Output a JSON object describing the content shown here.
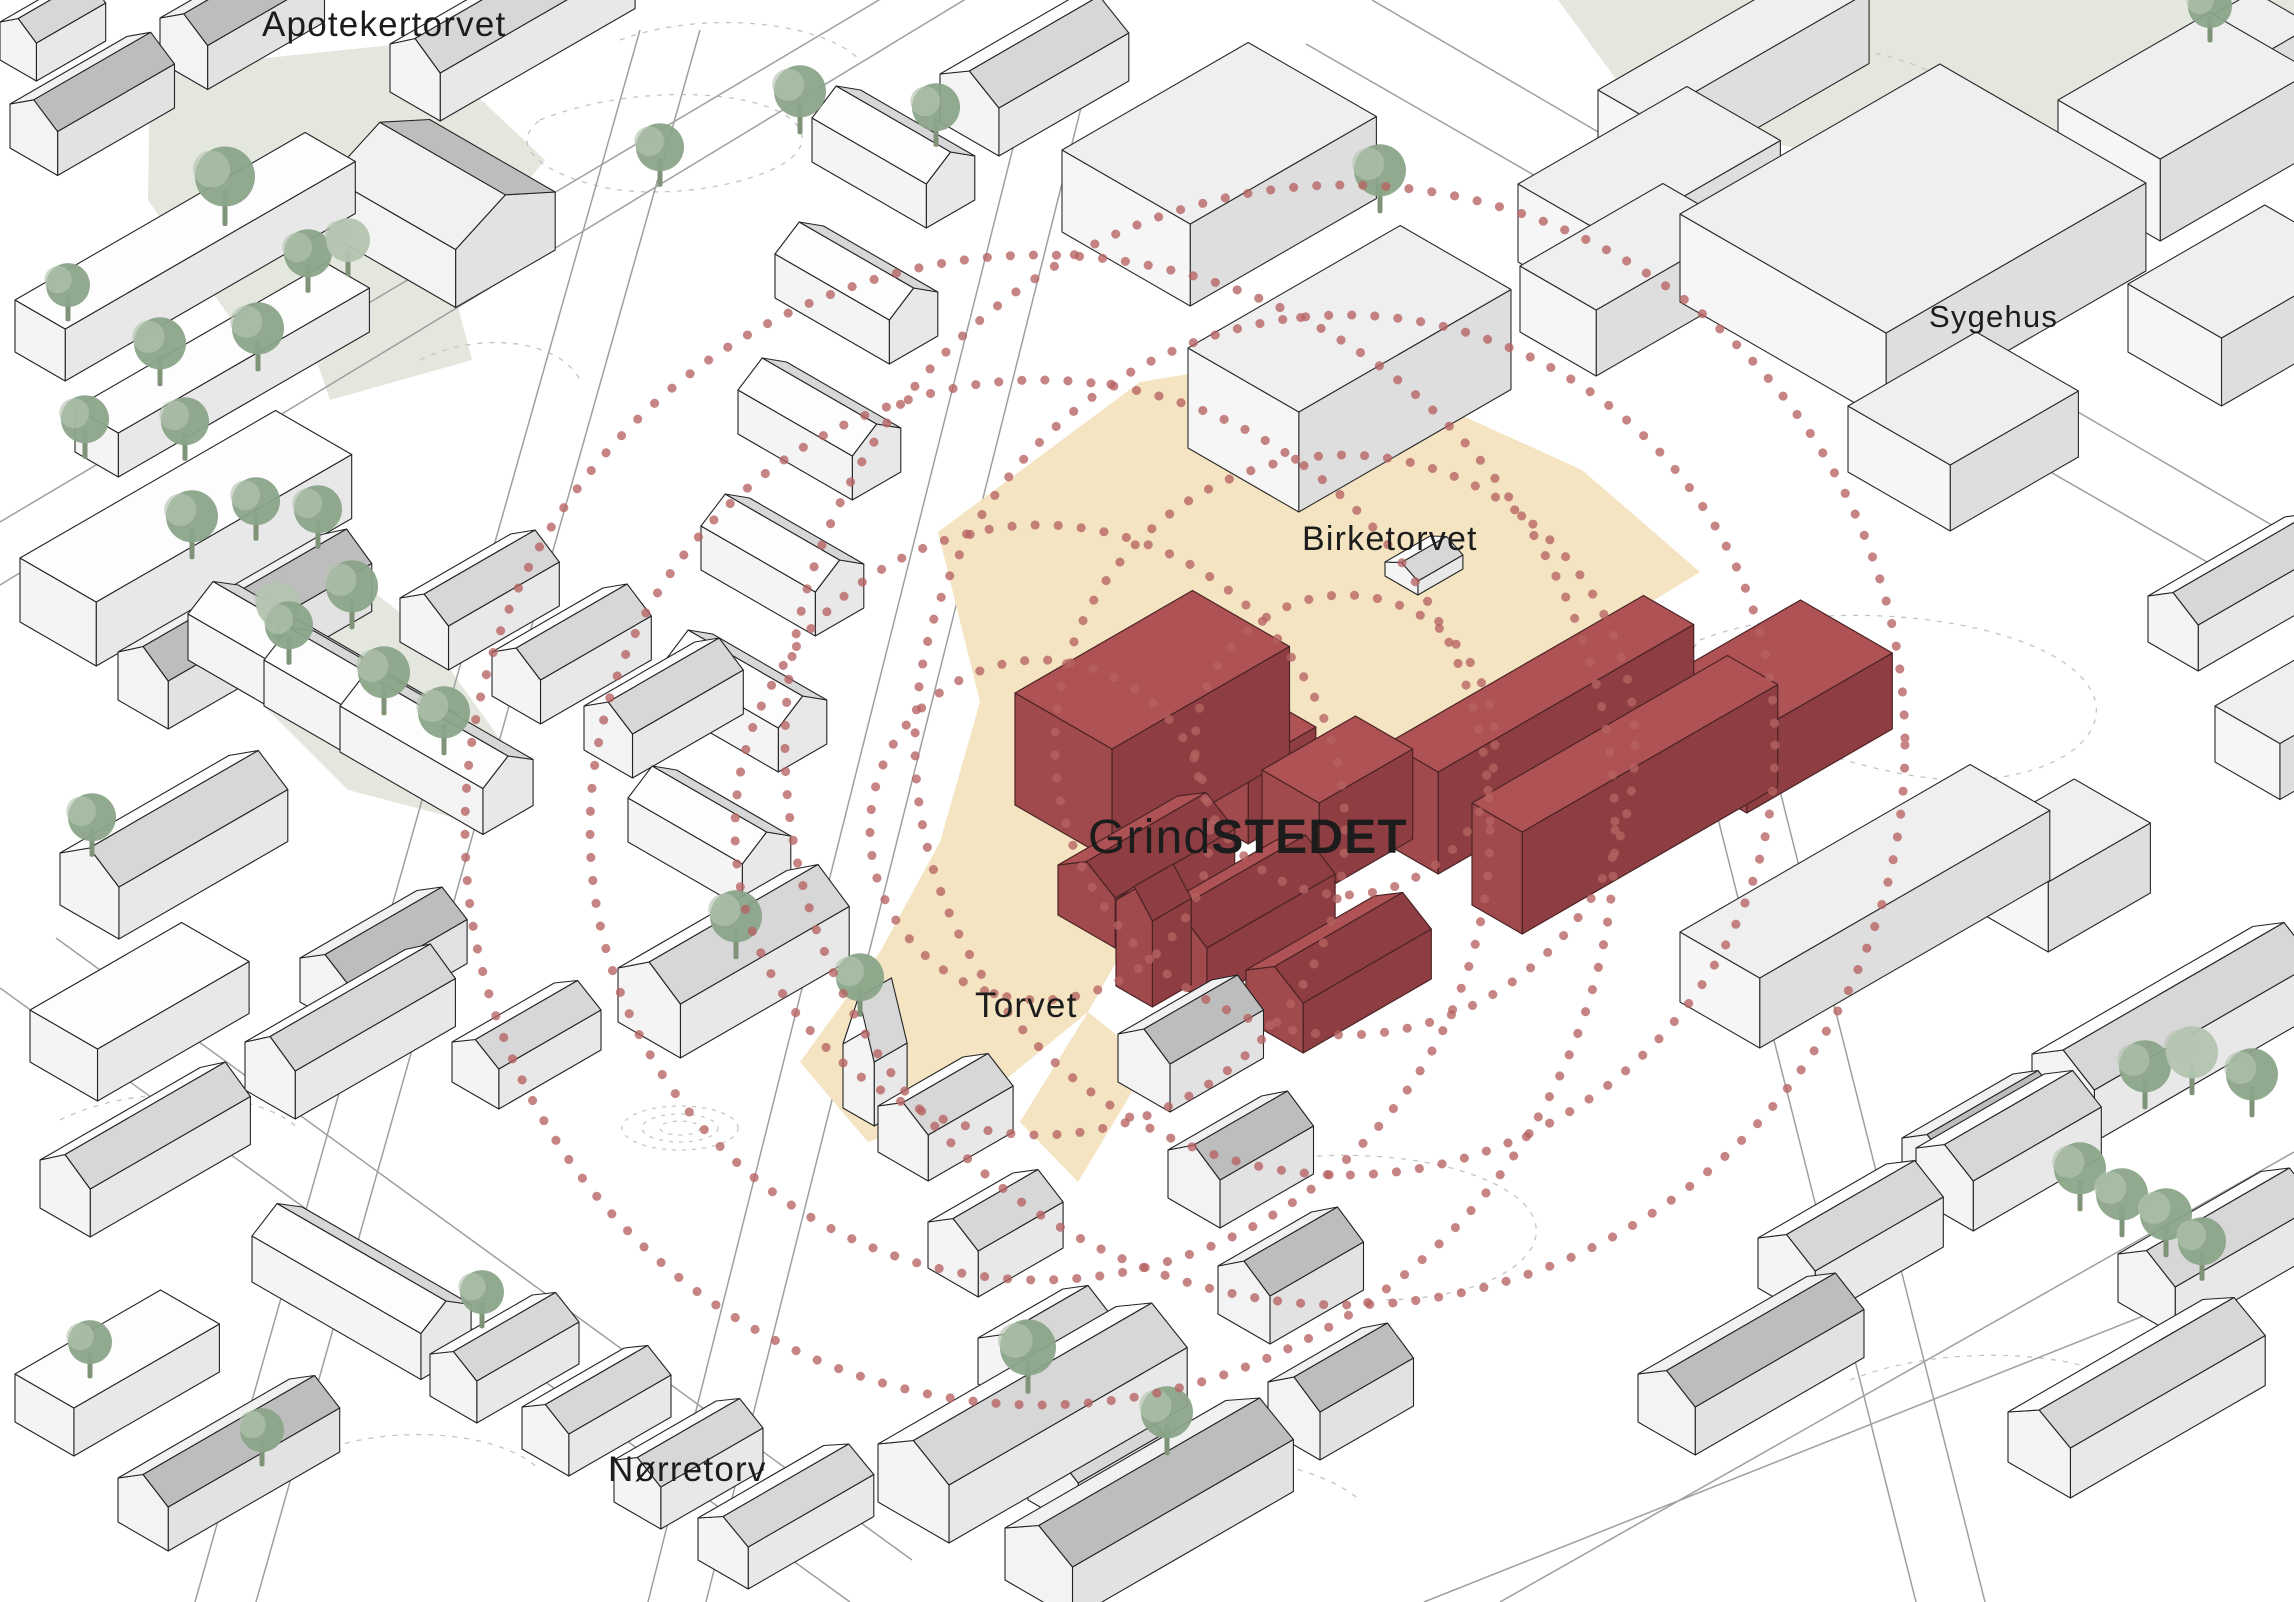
{
  "labels": {
    "apotekertorvet": {
      "text": "Apotekertorvet",
      "x": 262,
      "y": 36,
      "size": 35
    },
    "sygehus": {
      "text": "Sygehus",
      "x": 1929,
      "y": 327,
      "size": 31
    },
    "birketorvet": {
      "text": "Birketorvet",
      "x": 1302,
      "y": 550,
      "size": 34
    },
    "grindstedet": {
      "regular": "Grind",
      "bold": "STEDET",
      "x": 1088,
      "y": 853,
      "size": 48
    },
    "torvet": {
      "text": "Torvet",
      "x": 975,
      "y": 1017,
      "size": 35
    },
    "norretorv": {
      "text": "Nørretorv",
      "x": 608,
      "y": 1481,
      "size": 35
    }
  },
  "palette": {
    "background": "#ffffff",
    "beige": "#f4e4c2",
    "park": "#e4e7de",
    "red_top": "#ae5255",
    "red_side_dark": "#8e3e42",
    "red_side_light": "#a04a4e",
    "red_line": "#4b2324",
    "dots": "#b66361",
    "tree": "#8aa489",
    "tree_light": "#b3c4b0",
    "trunk": "#7f9379",
    "ink": "#1c1c1c",
    "road": "#9f9f9f",
    "contour": "#c4c4c4"
  },
  "scene": {
    "width": 2294,
    "height": 1602,
    "ground": [
      {
        "points": "150,70 420,42 545,160 430,300 240,332 148,200",
        "fill": "park"
      },
      {
        "points": "285,268 445,258 472,360 330,400",
        "fill": "park"
      },
      {
        "points": "168,560 280,518 422,630 502,742 470,822 348,790 218,660",
        "fill": "park"
      },
      {
        "points": "1558,0 2294,0 2294,112 1898,172 1640,112",
        "fill": "park"
      }
    ],
    "plazas": [
      {
        "points": "938,532 1140,382 1322,352 1582,470 1700,572 1520,682 1338,772 1202,802 1150,902 1088,1012 978,1102 868,1142 800,1062 880,952 940,842 980,702",
        "fill": "beige"
      },
      {
        "points": "1088,1012 1150,1062 1078,1182 1020,1122",
        "fill": "beige"
      }
    ],
    "roads": [
      [
        648,
        1602,
        1040,
        40
      ],
      [
        706,
        1602,
        1098,
        40
      ],
      [
        195,
        1602,
        640,
        30
      ],
      [
        256,
        1602,
        700,
        30
      ],
      [
        0,
        522,
        980,
        -60
      ],
      [
        0,
        585,
        1030,
        -40
      ],
      [
        0,
        988,
        850,
        1602
      ],
      [
        56,
        938,
        912,
        1560
      ],
      [
        1372,
        0,
        2294,
        538
      ],
      [
        1306,
        44,
        2294,
        612
      ],
      [
        1500,
        1602,
        2294,
        1152
      ],
      [
        1424,
        1602,
        2294,
        1256
      ],
      [
        1688,
        700,
        1916,
        1602
      ],
      [
        1757,
        700,
        1985,
        1602
      ]
    ],
    "contours": [
      "M540,120 C640,80 780,90 800,130 C820,170 700,200 620,190 C560,182 500,150 540,120",
      "M620,40 C700,10 820,20 860,60",
      "M1650,60 C1750,30 1900,40 1960,90 C2000,130 1930,170 1840,160",
      "M1700,640 C1800,600 1980,610 2060,660 C2140,710 2080,780 1960,780 C1860,780 1640,700 1700,640",
      "M1200,1180 C1300,1140 1460,1150 1520,1200 C1570,1245 1500,1300 1380,1300",
      "M300,1460 C380,1420 500,1430 540,1470",
      "M1050,1480 C1150,1440 1300,1450 1360,1500",
      "M420,360 C480,330 560,340 580,380",
      "M1850,1380 C1950,1340 2100,1350 2160,1400",
      "M60,1120 C140,1080 260,1090 300,1130"
    ],
    "spirals": [
      [
        680,
        1128,
        58,
        22
      ],
      [
        680,
        1128,
        38,
        14
      ],
      [
        680,
        1128,
        20,
        7
      ],
      [
        1100,
        1547,
        60,
        22
      ],
      [
        1100,
        1547,
        35,
        12
      ]
    ],
    "circle_families": [
      {
        "cx": 1040,
        "cy": 830,
        "r": [
          170,
          305,
          450,
          575
        ]
      },
      {
        "cx": 1345,
        "cy": 745,
        "r": [
          150,
          290,
          430,
          560
        ]
      }
    ],
    "buildings": [
      [
        10,
        148,
        135,
        55,
        44,
        "d",
        1,
        18
      ],
      [
        160,
        62,
        135,
        55,
        44,
        "d",
        1,
        18
      ],
      [
        390,
        92,
        225,
        58,
        48,
        "w",
        1,
        20
      ],
      [
        330,
        235,
        115,
        145,
        58,
        "d",
        2,
        26
      ],
      [
        15,
        352,
        335,
        58,
        52,
        "w",
        0,
        0
      ],
      [
        75,
        452,
        290,
        50,
        44,
        "w",
        0,
        0
      ],
      [
        0,
        60,
        80,
        42,
        38,
        "w",
        1,
        14
      ],
      [
        20,
        622,
        295,
        88,
        64,
        "w",
        0,
        0
      ],
      [
        118,
        700,
        235,
        58,
        48,
        "d",
        1,
        20
      ],
      [
        60,
        905,
        195,
        68,
        52,
        "w",
        1,
        22
      ],
      [
        30,
        1062,
        175,
        78,
        52,
        "w",
        0,
        0
      ],
      [
        300,
        1002,
        135,
        58,
        44,
        "d",
        1,
        18
      ],
      [
        452,
        1082,
        118,
        54,
        40,
        "w",
        1,
        16
      ],
      [
        252,
        1282,
        58,
        195,
        46,
        "w",
        2,
        18
      ],
      [
        15,
        1422,
        168,
        68,
        48,
        "w",
        0,
        0
      ],
      [
        118,
        1522,
        198,
        58,
        44,
        "d",
        1,
        18
      ],
      [
        878,
        1502,
        275,
        82,
        58,
        "w",
        1,
        24
      ],
      [
        1005,
        1580,
        255,
        78,
        52,
        "d",
        1,
        22
      ],
      [
        698,
        1560,
        145,
        58,
        42,
        "w",
        1,
        16
      ],
      [
        940,
        122,
        150,
        68,
        48,
        "w",
        1,
        20
      ],
      [
        1062,
        232,
        215,
        148,
        82,
        "g",
        0,
        0
      ],
      [
        1188,
        448,
        245,
        128,
        100,
        "g",
        0,
        0
      ],
      [
        1385,
        576,
        52,
        38,
        14,
        "w",
        1,
        9
      ],
      [
        1520,
        332,
        165,
        88,
        66,
        "g",
        0,
        0
      ],
      [
        1680,
        302,
        300,
        238,
        88,
        "g",
        0,
        0
      ],
      [
        1518,
        262,
        195,
        108,
        78,
        "g",
        0,
        0
      ],
      [
        1598,
        162,
        255,
        58,
        72,
        "g",
        0,
        0
      ],
      [
        2058,
        182,
        175,
        118,
        82,
        "g",
        0,
        0
      ],
      [
        2128,
        352,
        158,
        108,
        68,
        "g",
        0,
        0
      ],
      [
        1848,
        472,
        148,
        118,
        66,
        "g",
        0,
        0
      ],
      [
        2180,
        122,
        85,
        68,
        88,
        "g",
        0,
        0
      ],
      [
        1015,
        805,
        205,
        112,
        112,
        "r",
        0,
        0
      ],
      [
        1198,
        815,
        78,
        58,
        78,
        "r",
        0,
        0
      ],
      [
        1262,
        860,
        108,
        66,
        90,
        "r",
        0,
        0
      ],
      [
        1388,
        845,
        295,
        58,
        102,
        "r",
        0,
        0
      ],
      [
        1472,
        905,
        295,
        58,
        102,
        "r",
        0,
        0
      ],
      [
        1655,
        760,
        168,
        106,
        76,
        "r",
        0,
        0
      ],
      [
        1058,
        915,
        138,
        66,
        50,
        "r",
        1,
        20
      ],
      [
        1148,
        968,
        148,
        68,
        54,
        "r",
        1,
        22
      ],
      [
        1246,
        1020,
        148,
        66,
        50,
        "r",
        1,
        20
      ],
      [
        1116,
        986,
        45,
        42,
        86,
        "r",
        1,
        24
      ],
      [
        1680,
        1002,
        335,
        92,
        70,
        "g",
        0,
        0
      ],
      [
        1972,
        908,
        118,
        88,
        70,
        "g",
        0,
        0
      ],
      [
        2032,
        1106,
        255,
        72,
        52,
        "w",
        1,
        22
      ],
      [
        1902,
        1182,
        128,
        58,
        44,
        "d",
        1,
        18
      ],
      [
        2118,
        1302,
        165,
        66,
        48,
        "w",
        1,
        20
      ],
      [
        1638,
        1422,
        195,
        66,
        48,
        "d",
        1,
        20
      ],
      [
        2008,
        1462,
        225,
        72,
        50,
        "w",
        1,
        20
      ],
      [
        2148,
        642,
        158,
        58,
        46,
        "w",
        1,
        18
      ],
      [
        2215,
        762,
        135,
        75,
        56,
        "g",
        0,
        0
      ],
      [
        618,
        1022,
        195,
        72,
        54,
        "w",
        1,
        24
      ],
      [
        843,
        1108,
        38,
        36,
        64,
        "w",
        1,
        56
      ],
      [
        628,
        842,
        56,
        132,
        44,
        "w",
        2,
        18
      ]
    ],
    "building_rows": [
      [
        400,
        642,
        3,
        92,
        54,
        128,
        56,
        44,
        "w",
        1,
        18
      ],
      [
        188,
        660,
        3,
        76,
        46,
        58,
        165,
        46,
        "w",
        2,
        18
      ],
      [
        40,
        1208,
        2,
        205,
        -118,
        185,
        58,
        48,
        "w",
        1,
        20
      ],
      [
        430,
        1396,
        3,
        92,
        53,
        118,
        54,
        42,
        "w",
        1,
        16
      ],
      [
        812,
        162,
        5,
        -37,
        136,
        56,
        132,
        44,
        "w",
        2,
        18
      ],
      [
        1758,
        1288,
        2,
        158,
        -90,
        148,
        66,
        50,
        "w",
        1,
        20
      ],
      [
        878,
        1152,
        4,
        50,
        116,
        98,
        58,
        46,
        "w",
        1,
        18
      ],
      [
        1118,
        1082,
        4,
        50,
        116,
        108,
        60,
        48,
        "d",
        1,
        20
      ]
    ],
    "trees": [
      [
        225,
        190,
        30,
        0
      ],
      [
        160,
        355,
        26,
        0
      ],
      [
        258,
        340,
        26,
        0
      ],
      [
        68,
        295,
        22,
        0
      ],
      [
        308,
        264,
        24,
        0
      ],
      [
        348,
        250,
        22,
        1
      ],
      [
        85,
        430,
        24,
        0
      ],
      [
        185,
        432,
        24,
        0
      ],
      [
        192,
        528,
        26,
        0
      ],
      [
        256,
        512,
        24,
        0
      ],
      [
        318,
        520,
        24,
        0
      ],
      [
        352,
        598,
        26,
        0
      ],
      [
        278,
        614,
        22,
        1
      ],
      [
        289,
        636,
        24,
        0
      ],
      [
        384,
        684,
        26,
        0
      ],
      [
        444,
        724,
        26,
        0
      ],
      [
        92,
        828,
        24,
        0
      ],
      [
        660,
        158,
        24,
        0
      ],
      [
        800,
        103,
        26,
        0
      ],
      [
        936,
        118,
        24,
        0
      ],
      [
        1380,
        182,
        26,
        0
      ],
      [
        2210,
        16,
        22,
        0
      ],
      [
        2080,
        1180,
        26,
        0
      ],
      [
        2122,
        1206,
        26,
        0
      ],
      [
        2166,
        1226,
        26,
        0
      ],
      [
        2202,
        1252,
        24,
        0
      ],
      [
        2145,
        1078,
        26,
        0
      ],
      [
        2192,
        1064,
        26,
        1
      ],
      [
        2252,
        1086,
        26,
        0
      ],
      [
        1028,
        1360,
        28,
        0
      ],
      [
        1167,
        1424,
        26,
        0
      ],
      [
        736,
        928,
        26,
        0
      ],
      [
        860,
        988,
        24,
        0
      ],
      [
        90,
        1352,
        22,
        0
      ],
      [
        482,
        1302,
        22,
        0
      ],
      [
        262,
        1440,
        22,
        0
      ]
    ]
  }
}
